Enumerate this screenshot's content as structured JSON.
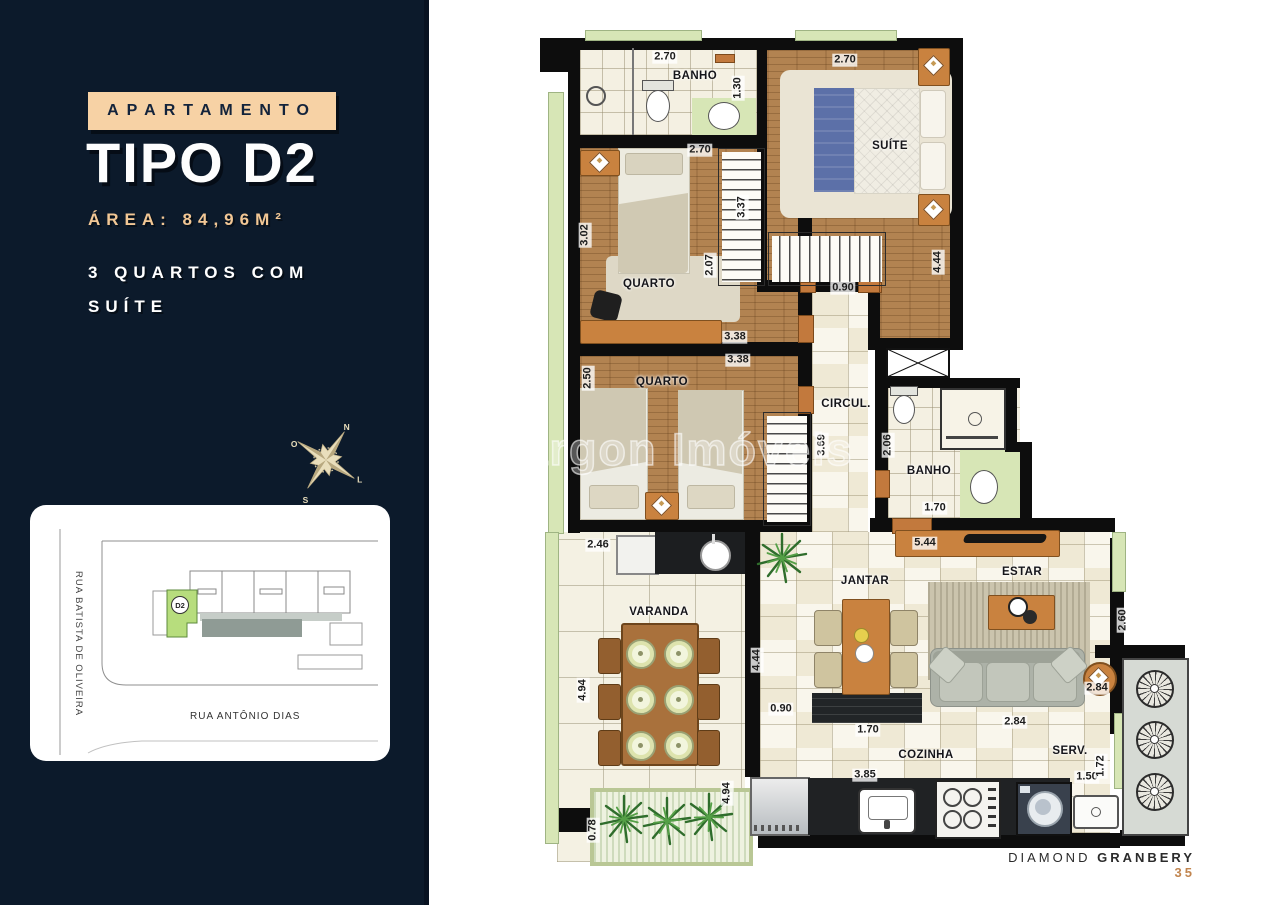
{
  "sidebar": {
    "badge": "APARTAMENTO",
    "title": "TIPO D2",
    "area_label": "ÁREA: 84,96M²",
    "feature_line1": "3 QUARTOS COM",
    "feature_line2": "SUÍTE",
    "compass": {
      "n": "N",
      "o": "O",
      "s": "S",
      "l": "L"
    },
    "map": {
      "street_left": "RUA BATISTA DE OLIVEIRA",
      "street_bottom": "RUA ANTÔNIO DIAS",
      "unit": "D2"
    }
  },
  "plan": {
    "watermark": "Bargon Imóveis",
    "labels": {
      "banho1": "BANHO",
      "suite": "SUÍTE",
      "quarto1": "QUARTO",
      "quarto2": "QUARTO",
      "circul": "CIRCUL.",
      "banho2": "BANHO",
      "varanda": "VARANDA",
      "jantar": "JANTAR",
      "estar": "ESTAR",
      "cozinha": "COZINHA",
      "serv": "SERV."
    },
    "dims": {
      "banho1_w": "2.70",
      "banho1_d": "1.30",
      "suite_w": "2.70",
      "suite_d": "3.37",
      "suite_d2": "4.44",
      "q1_w": "2.70",
      "q1_d": "3.02",
      "q1_ward": "2.07",
      "q1_b": "3.38",
      "q2_t": "3.38",
      "q2_d": "2.50",
      "circ_w": "0.90",
      "circ_d": "3.69",
      "banho2_d": "2.06",
      "banho2_w": "1.70",
      "estar_sb": "5.44",
      "estar_d": "2.60",
      "estar_w": "2.84",
      "coz_t": "2.84",
      "coz_w": "3.85",
      "hall_d": "4.44",
      "hall_w": "0.90",
      "jantar_w": "1.70",
      "varanda_t": "2.46",
      "varanda_d": "4.94",
      "varanda_d2": "4.94",
      "planter_d": "0.78",
      "serv_w": "1.50",
      "serv_d": "1.72"
    }
  },
  "footer": {
    "brand_regular": "DIAMOND",
    "brand_bold": "GRANBERY",
    "page": "35"
  },
  "colors": {
    "navy": "#0c1a2b",
    "peach": "#f7d2a5",
    "peach_text": "#f2c795",
    "orange": "#c9823f",
    "green_unit": "#b7dd7d",
    "accent_page": "#c1854f"
  }
}
